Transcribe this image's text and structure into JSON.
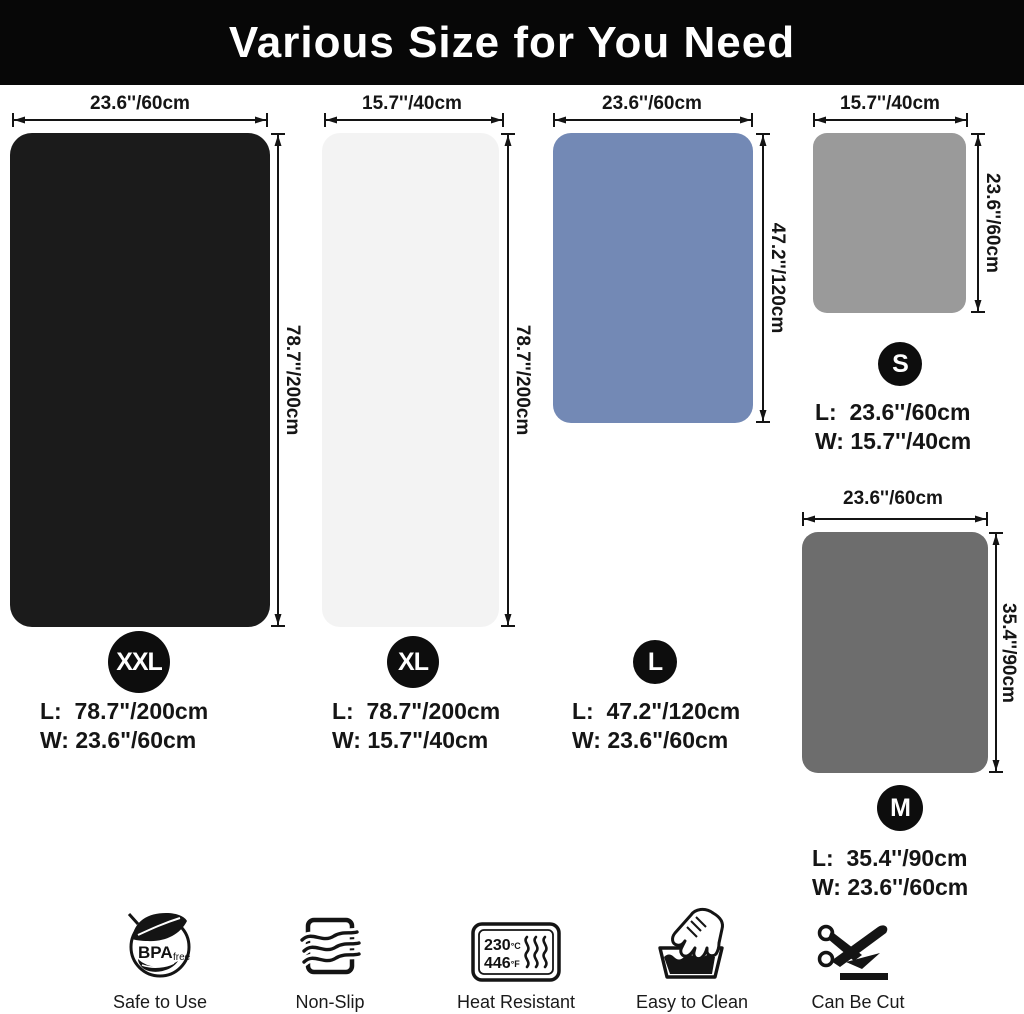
{
  "header": {
    "title": "Various Size for You Need"
  },
  "colors": {
    "header_bg": "#070707",
    "badge_bg": "#0d0d0d",
    "badge_text": "#ffffff",
    "dimension_line": "#141414",
    "background": "#ffffff"
  },
  "mats": [
    {
      "id": "xxl",
      "badge": "XXL",
      "color": "#1b1b1b",
      "width_label": "23.6''/60cm",
      "height_label": "78.7''/200cm",
      "spec_l": "L:  78.7\"/200cm",
      "spec_w": "W: 23.6\"/60cm"
    },
    {
      "id": "xl",
      "badge": "XL",
      "color": "#f3f3f3",
      "width_label": "15.7''/40cm",
      "height_label": "78.7''/200cm",
      "spec_l": "L:  78.7\"/200cm",
      "spec_w": "W: 15.7\"/40cm"
    },
    {
      "id": "l",
      "badge": "L",
      "color": "#7389b5",
      "width_label": "23.6''/60cm",
      "height_label": "47.2''/120cm",
      "spec_l": "L:  47.2\"/120cm",
      "spec_w": "W: 23.6\"/60cm"
    },
    {
      "id": "s",
      "badge": "S",
      "color": "#9a9a9a",
      "width_label": "15.7''/40cm",
      "height_label": "23.6''/60cm",
      "spec_l": "L:  23.6''/60cm",
      "spec_w": "W: 15.7''/40cm"
    },
    {
      "id": "m",
      "badge": "M",
      "color": "#6d6d6d",
      "width_label": "23.6''/60cm",
      "height_label": "35.4''/90cm",
      "spec_l": "L:  35.4''/90cm",
      "spec_w": "W: 23.6''/60cm"
    }
  ],
  "features": [
    {
      "name": "bpa-free",
      "label": "Safe to Use",
      "bpa": "BPA",
      "free": "free"
    },
    {
      "name": "non-slip",
      "label": "Non-Slip"
    },
    {
      "name": "heat-resistant",
      "label": "Heat Resistant",
      "c_value": "230",
      "c_unit": "°C",
      "f_value": "446",
      "f_unit": "°F"
    },
    {
      "name": "easy-to-clean",
      "label": "Easy to Clean"
    },
    {
      "name": "can-be-cut",
      "label": "Can Be Cut"
    }
  ]
}
